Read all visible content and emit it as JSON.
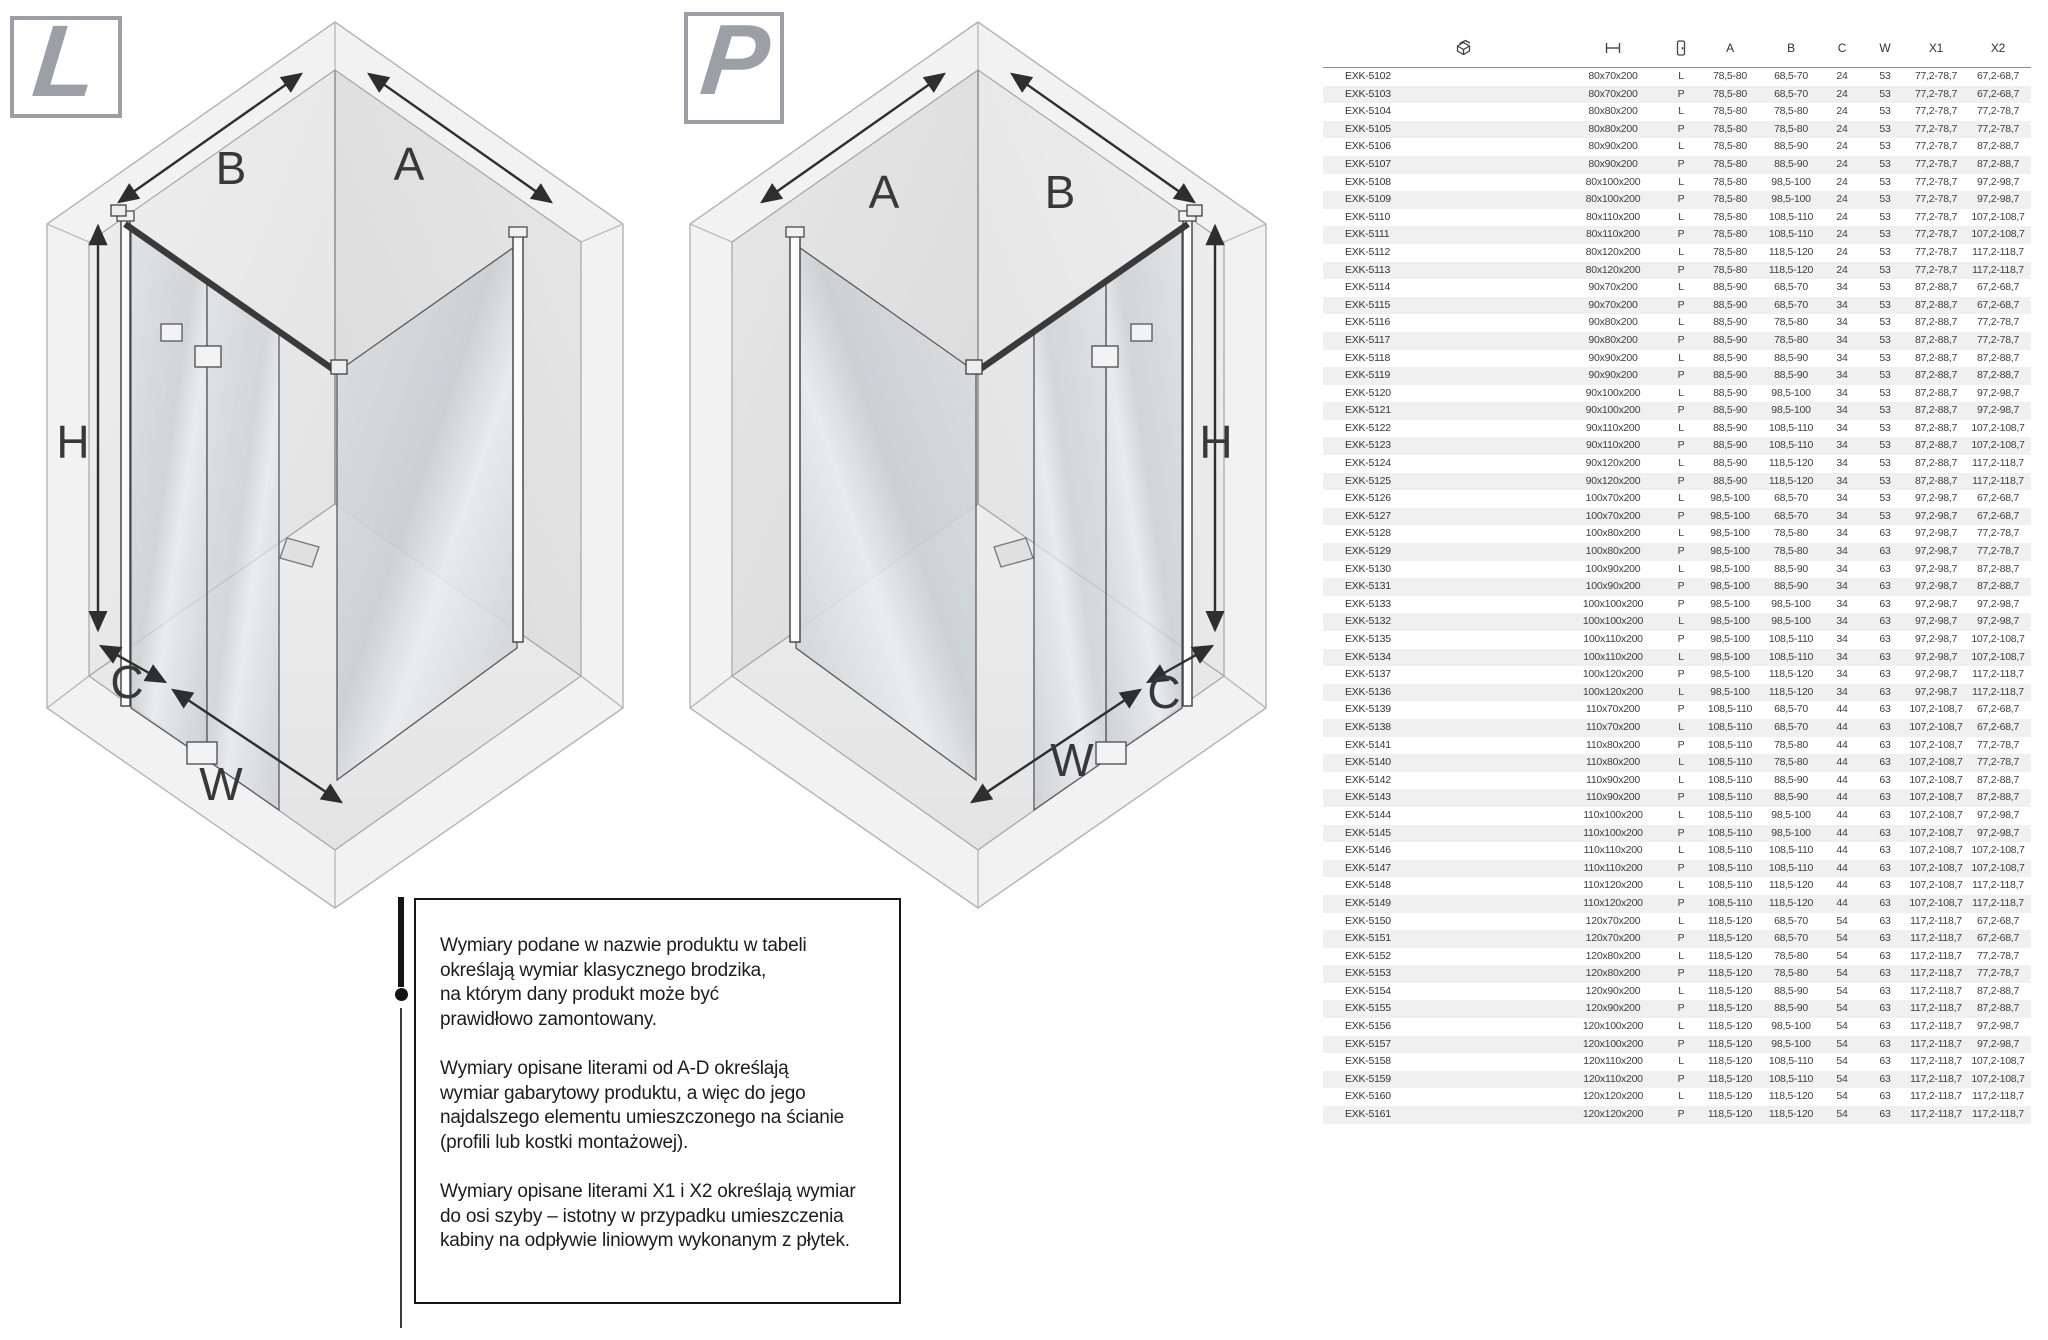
{
  "diagrams": {
    "left": {
      "badge": "L",
      "labels": {
        "top_left": "B",
        "top_right": "A",
        "height": "H",
        "corner": "C",
        "front": "W"
      }
    },
    "right": {
      "badge": "P",
      "labels": {
        "top_left": "A",
        "top_right": "B",
        "height": "H",
        "corner": "C",
        "front": "W"
      }
    }
  },
  "note": {
    "paragraphs": [
      "Wymiary podane w nazwie produktu w tabeli\nokreślają wymiar klasycznego brodzika,\nna którym dany produkt może być\nprawidłowo zamontowany.",
      "Wymiary opisane literami od A-D określają\nwymiar gabarytowy produktu, a więc do jego\nnajdalszego elementu umieszczonego na ścianie\n(profili lub kostki montażowej).",
      "Wymiary opisane literami X1 i X2 określają wymiar\ndo osi szyby – istotny w przypadku umieszczenia\nkabiny na odpływie liniowym wykonanym z płytek."
    ]
  },
  "table": {
    "header": {
      "icons": [
        "product-icon",
        "size-dimension-icon",
        "door-side-icon"
      ],
      "columns": [
        "A",
        "B",
        "C",
        "W",
        "X1",
        "X2"
      ]
    },
    "rows": [
      [
        "EXK-5102",
        "80x70x200",
        "L",
        "78,5-80",
        "68,5-70",
        "24",
        "53",
        "77,2-78,7",
        "67,2-68,7"
      ],
      [
        "EXK-5103",
        "80x70x200",
        "P",
        "78,5-80",
        "68,5-70",
        "24",
        "53",
        "77,2-78,7",
        "67,2-68,7"
      ],
      [
        "EXK-5104",
        "80x80x200",
        "L",
        "78,5-80",
        "78,5-80",
        "24",
        "53",
        "77,2-78,7",
        "77,2-78,7"
      ],
      [
        "EXK-5105",
        "80x80x200",
        "P",
        "78,5-80",
        "78,5-80",
        "24",
        "53",
        "77,2-78,7",
        "77,2-78,7"
      ],
      [
        "EXK-5106",
        "80x90x200",
        "L",
        "78,5-80",
        "88,5-90",
        "24",
        "53",
        "77,2-78,7",
        "87,2-88,7"
      ],
      [
        "EXK-5107",
        "80x90x200",
        "P",
        "78,5-80",
        "88,5-90",
        "24",
        "53",
        "77,2-78,7",
        "87,2-88,7"
      ],
      [
        "EXK-5108",
        "80x100x200",
        "L",
        "78,5-80",
        "98,5-100",
        "24",
        "53",
        "77,2-78,7",
        "97,2-98,7"
      ],
      [
        "EXK-5109",
        "80x100x200",
        "P",
        "78,5-80",
        "98,5-100",
        "24",
        "53",
        "77,2-78,7",
        "97,2-98,7"
      ],
      [
        "EXK-5110",
        "80x110x200",
        "L",
        "78,5-80",
        "108,5-110",
        "24",
        "53",
        "77,2-78,7",
        "107,2-108,7"
      ],
      [
        "EXK-5111",
        "80x110x200",
        "P",
        "78,5-80",
        "108,5-110",
        "24",
        "53",
        "77,2-78,7",
        "107,2-108,7"
      ],
      [
        "EXK-5112",
        "80x120x200",
        "L",
        "78,5-80",
        "118,5-120",
        "24",
        "53",
        "77,2-78,7",
        "117,2-118,7"
      ],
      [
        "EXK-5113",
        "80x120x200",
        "P",
        "78,5-80",
        "118,5-120",
        "24",
        "53",
        "77,2-78,7",
        "117,2-118,7"
      ],
      [
        "EXK-5114",
        "90x70x200",
        "L",
        "88,5-90",
        "68,5-70",
        "34",
        "53",
        "87,2-88,7",
        "67,2-68,7"
      ],
      [
        "EXK-5115",
        "90x70x200",
        "P",
        "88,5-90",
        "68,5-70",
        "34",
        "53",
        "87,2-88,7",
        "67,2-68,7"
      ],
      [
        "EXK-5116",
        "90x80x200",
        "L",
        "88,5-90",
        "78,5-80",
        "34",
        "53",
        "87,2-88,7",
        "77,2-78,7"
      ],
      [
        "EXK-5117",
        "90x80x200",
        "P",
        "88,5-90",
        "78,5-80",
        "34",
        "53",
        "87,2-88,7",
        "77,2-78,7"
      ],
      [
        "EXK-5118",
        "90x90x200",
        "L",
        "88,5-90",
        "88,5-90",
        "34",
        "53",
        "87,2-88,7",
        "87,2-88,7"
      ],
      [
        "EXK-5119",
        "90x90x200",
        "P",
        "88,5-90",
        "88,5-90",
        "34",
        "53",
        "87,2-88,7",
        "87,2-88,7"
      ],
      [
        "EXK-5120",
        "90x100x200",
        "L",
        "88,5-90",
        "98,5-100",
        "34",
        "53",
        "87,2-88,7",
        "97,2-98,7"
      ],
      [
        "EXK-5121",
        "90x100x200",
        "P",
        "88,5-90",
        "98,5-100",
        "34",
        "53",
        "87,2-88,7",
        "97,2-98,7"
      ],
      [
        "EXK-5122",
        "90x110x200",
        "L",
        "88,5-90",
        "108,5-110",
        "34",
        "53",
        "87,2-88,7",
        "107,2-108,7"
      ],
      [
        "EXK-5123",
        "90x110x200",
        "P",
        "88,5-90",
        "108,5-110",
        "34",
        "53",
        "87,2-88,7",
        "107,2-108,7"
      ],
      [
        "EXK-5124",
        "90x120x200",
        "L",
        "88,5-90",
        "118,5-120",
        "34",
        "53",
        "87,2-88,7",
        "117,2-118,7"
      ],
      [
        "EXK-5125",
        "90x120x200",
        "P",
        "88,5-90",
        "118,5-120",
        "34",
        "53",
        "87,2-88,7",
        "117,2-118,7"
      ],
      [
        "EXK-5126",
        "100x70x200",
        "L",
        "98,5-100",
        "68,5-70",
        "34",
        "53",
        "97,2-98,7",
        "67,2-68,7"
      ],
      [
        "EXK-5127",
        "100x70x200",
        "P",
        "98,5-100",
        "68,5-70",
        "34",
        "53",
        "97,2-98,7",
        "67,2-68,7"
      ],
      [
        "EXK-5128",
        "100x80x200",
        "L",
        "98,5-100",
        "78,5-80",
        "34",
        "63",
        "97,2-98,7",
        "77,2-78,7"
      ],
      [
        "EXK-5129",
        "100x80x200",
        "P",
        "98,5-100",
        "78,5-80",
        "34",
        "63",
        "97,2-98,7",
        "77,2-78,7"
      ],
      [
        "EXK-5130",
        "100x90x200",
        "L",
        "98,5-100",
        "88,5-90",
        "34",
        "63",
        "97,2-98,7",
        "87,2-88,7"
      ],
      [
        "EXK-5131",
        "100x90x200",
        "P",
        "98,5-100",
        "88,5-90",
        "34",
        "63",
        "97,2-98,7",
        "87,2-88,7"
      ],
      [
        "EXK-5133",
        "100x100x200",
        "P",
        "98,5-100",
        "98,5-100",
        "34",
        "63",
        "97,2-98,7",
        "97,2-98,7"
      ],
      [
        "EXK-5132",
        "100x100x200",
        "L",
        "98,5-100",
        "98,5-100",
        "34",
        "63",
        "97,2-98,7",
        "97,2-98,7"
      ],
      [
        "EXK-5135",
        "100x110x200",
        "P",
        "98,5-100",
        "108,5-110",
        "34",
        "63",
        "97,2-98,7",
        "107,2-108,7"
      ],
      [
        "EXK-5134",
        "100x110x200",
        "L",
        "98,5-100",
        "108,5-110",
        "34",
        "63",
        "97,2-98,7",
        "107,2-108,7"
      ],
      [
        "EXK-5137",
        "100x120x200",
        "P",
        "98,5-100",
        "118,5-120",
        "34",
        "63",
        "97,2-98,7",
        "117,2-118,7"
      ],
      [
        "EXK-5136",
        "100x120x200",
        "L",
        "98,5-100",
        "118,5-120",
        "34",
        "63",
        "97,2-98,7",
        "117,2-118,7"
      ],
      [
        "EXK-5139",
        "110x70x200",
        "P",
        "108,5-110",
        "68,5-70",
        "44",
        "63",
        "107,2-108,7",
        "67,2-68,7"
      ],
      [
        "EXK-5138",
        "110x70x200",
        "L",
        "108,5-110",
        "68,5-70",
        "44",
        "63",
        "107,2-108,7",
        "67,2-68,7"
      ],
      [
        "EXK-5141",
        "110x80x200",
        "P",
        "108,5-110",
        "78,5-80",
        "44",
        "63",
        "107,2-108,7",
        "77,2-78,7"
      ],
      [
        "EXK-5140",
        "110x80x200",
        "L",
        "108,5-110",
        "78,5-80",
        "44",
        "63",
        "107,2-108,7",
        "77,2-78,7"
      ],
      [
        "EXK-5142",
        "110x90x200",
        "L",
        "108,5-110",
        "88,5-90",
        "44",
        "63",
        "107,2-108,7",
        "87,2-88,7"
      ],
      [
        "EXK-5143",
        "110x90x200",
        "P",
        "108,5-110",
        "88,5-90",
        "44",
        "63",
        "107,2-108,7",
        "87,2-88,7"
      ],
      [
        "EXK-5144",
        "110x100x200",
        "L",
        "108,5-110",
        "98,5-100",
        "44",
        "63",
        "107,2-108,7",
        "97,2-98,7"
      ],
      [
        "EXK-5145",
        "110x100x200",
        "P",
        "108,5-110",
        "98,5-100",
        "44",
        "63",
        "107,2-108,7",
        "97,2-98,7"
      ],
      [
        "EXK-5146",
        "110x110x200",
        "L",
        "108,5-110",
        "108,5-110",
        "44",
        "63",
        "107,2-108,7",
        "107,2-108,7"
      ],
      [
        "EXK-5147",
        "110x110x200",
        "P",
        "108,5-110",
        "108,5-110",
        "44",
        "63",
        "107,2-108,7",
        "107,2-108,7"
      ],
      [
        "EXK-5148",
        "110x120x200",
        "L",
        "108,5-110",
        "118,5-120",
        "44",
        "63",
        "107,2-108,7",
        "117,2-118,7"
      ],
      [
        "EXK-5149",
        "110x120x200",
        "P",
        "108,5-110",
        "118,5-120",
        "44",
        "63",
        "107,2-108,7",
        "117,2-118,7"
      ],
      [
        "EXK-5150",
        "120x70x200",
        "L",
        "118,5-120",
        "68,5-70",
        "54",
        "63",
        "117,2-118,7",
        "67,2-68,7"
      ],
      [
        "EXK-5151",
        "120x70x200",
        "P",
        "118,5-120",
        "68,5-70",
        "54",
        "63",
        "117,2-118,7",
        "67,2-68,7"
      ],
      [
        "EXK-5152",
        "120x80x200",
        "L",
        "118,5-120",
        "78,5-80",
        "54",
        "63",
        "117,2-118,7",
        "77,2-78,7"
      ],
      [
        "EXK-5153",
        "120x80x200",
        "P",
        "118,5-120",
        "78,5-80",
        "54",
        "63",
        "117,2-118,7",
        "77,2-78,7"
      ],
      [
        "EXK-5154",
        "120x90x200",
        "L",
        "118,5-120",
        "88,5-90",
        "54",
        "63",
        "117,2-118,7",
        "87,2-88,7"
      ],
      [
        "EXK-5155",
        "120x90x200",
        "P",
        "118,5-120",
        "88,5-90",
        "54",
        "63",
        "117,2-118,7",
        "87,2-88,7"
      ],
      [
        "EXK-5156",
        "120x100x200",
        "L",
        "118,5-120",
        "98,5-100",
        "54",
        "63",
        "117,2-118,7",
        "97,2-98,7"
      ],
      [
        "EXK-5157",
        "120x100x200",
        "P",
        "118,5-120",
        "98,5-100",
        "54",
        "63",
        "117,2-118,7",
        "97,2-98,7"
      ],
      [
        "EXK-5158",
        "120x110x200",
        "L",
        "118,5-120",
        "108,5-110",
        "54",
        "63",
        "117,2-118,7",
        "107,2-108,7"
      ],
      [
        "EXK-5159",
        "120x110x200",
        "P",
        "118,5-120",
        "108,5-110",
        "54",
        "63",
        "117,2-118,7",
        "107,2-108,7"
      ],
      [
        "EXK-5160",
        "120x120x200",
        "L",
        "118,5-120",
        "118,5-120",
        "54",
        "63",
        "117,2-118,7",
        "117,2-118,7"
      ],
      [
        "EXK-5161",
        "120x120x200",
        "P",
        "118,5-120",
        "118,5-120",
        "54",
        "63",
        "117,2-118,7",
        "117,2-118,7"
      ]
    ]
  },
  "colors": {
    "badge_gray": "#9aa0a5",
    "row_stripe": "#f0f0f0",
    "line_dark": "#3a3a3a",
    "wall_light": "#ececec",
    "glass": "#ccd2d6"
  }
}
